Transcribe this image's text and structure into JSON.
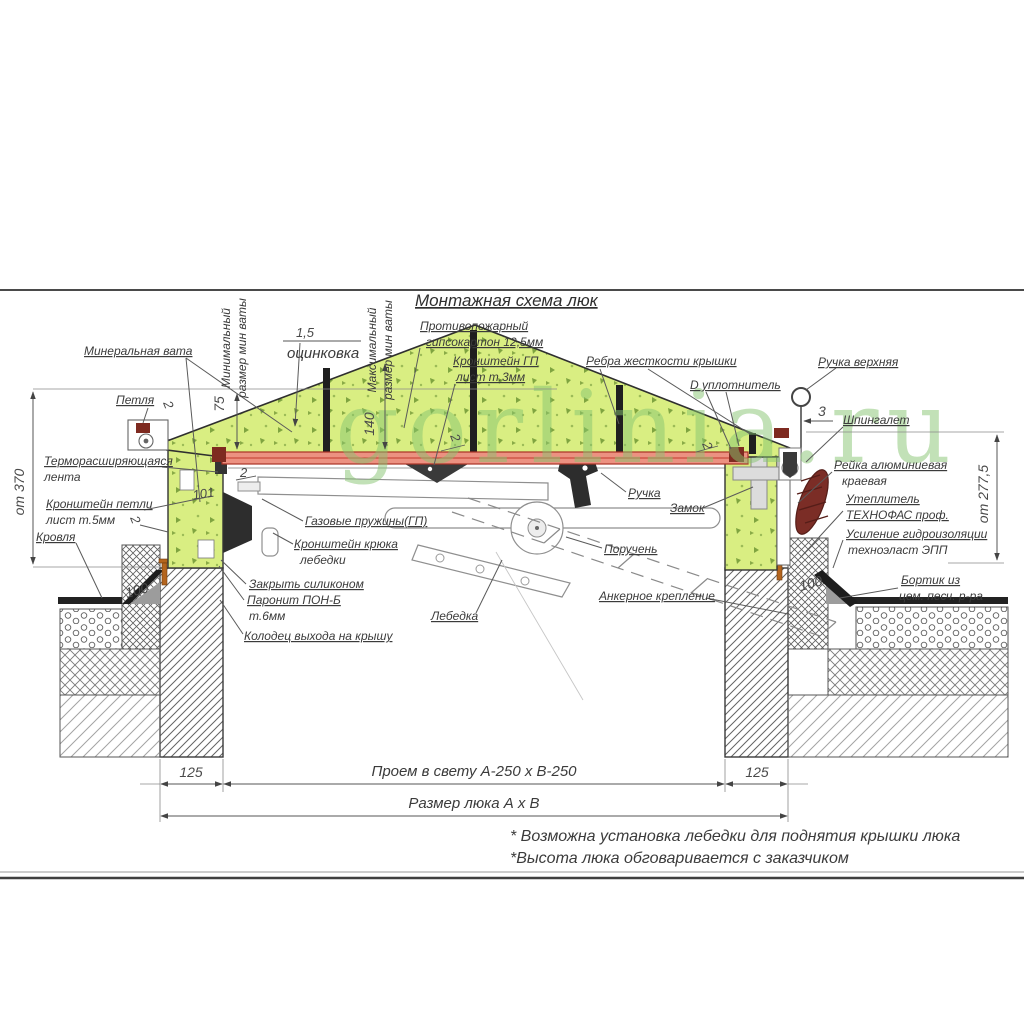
{
  "title": "Монтажная схема люк",
  "watermark": "gorlinia.ru",
  "callouts": {
    "fireproof_1": "Противопожарный",
    "fireproof_2": "гипсокартон 12,5мм",
    "zinc_value": "1,5",
    "zinc": "оцинковка",
    "bracket_gp_1": "Кронштейн ГП",
    "bracket_gp_2": "лист т.3мм",
    "ribs": "Ребра жесткости крышки",
    "seal_d": "D уплотнитель",
    "handle_top": "Ручка верхняя",
    "latch": "Шпингалет",
    "mineral_wool": "Минеральная вата",
    "min_wool_1": "Минимальный",
    "min_wool_2": "размер мин ваты",
    "max_wool_1": "Максимальный",
    "max_wool_2": "размер мин ваты",
    "hinge": "Петля",
    "thermal_tape_1": "Терморасширяющаяся",
    "thermal_tape_2": "лента",
    "hinge_bracket_1": "Кронштейн петли",
    "hinge_bracket_2": "лист т.5мм",
    "roof": "Кровля",
    "gas_springs": "Газовые пружины(ГП)",
    "winch_hook_1": "Кронштейн крюка",
    "winch_hook_2": "лебедки",
    "silicone": "Закрыть силиконом",
    "paronite_1": "Паронит ПОН-Б",
    "paronite_2": "т.6мм",
    "shaft": "Колодец выхода на крышу",
    "winch": "Лебедка",
    "anchor": "Анкерное крепление",
    "handle": "Ручка",
    "lock": "Замок",
    "handrail": "Поручень",
    "rail_1": "Рейка алюминиевая",
    "rail_2": "краевая",
    "insulation_1": "Утеплитель",
    "insulation_2": "ТЕХНОФАС проф.",
    "waterproof_1": "Усиление гидроизоляции",
    "waterproof_2": "техноэласт ЭПП",
    "curb_1": "Бортик из",
    "curb_2": "цем. песч. р-ра"
  },
  "dimensions": {
    "h370": "от 370",
    "h277": "от 277,5",
    "t75": "75",
    "t140": "140",
    "w101": "101",
    "t2a": "2",
    "t2b": "2",
    "t2c": "2",
    "t2d": "2",
    "t2e": "2",
    "t3": "3",
    "w100L": "100",
    "w100R": "100",
    "w125L": "125",
    "w125R": "125",
    "opening": "Проем в свету А-250 х В-250",
    "hatch_size": "Размер люка А х В"
  },
  "notes": {
    "n1": "* Возможна установка лебедки для поднятия крышки люка",
    "n2": "*Высота люка обговаривается с заказчиком"
  }
}
